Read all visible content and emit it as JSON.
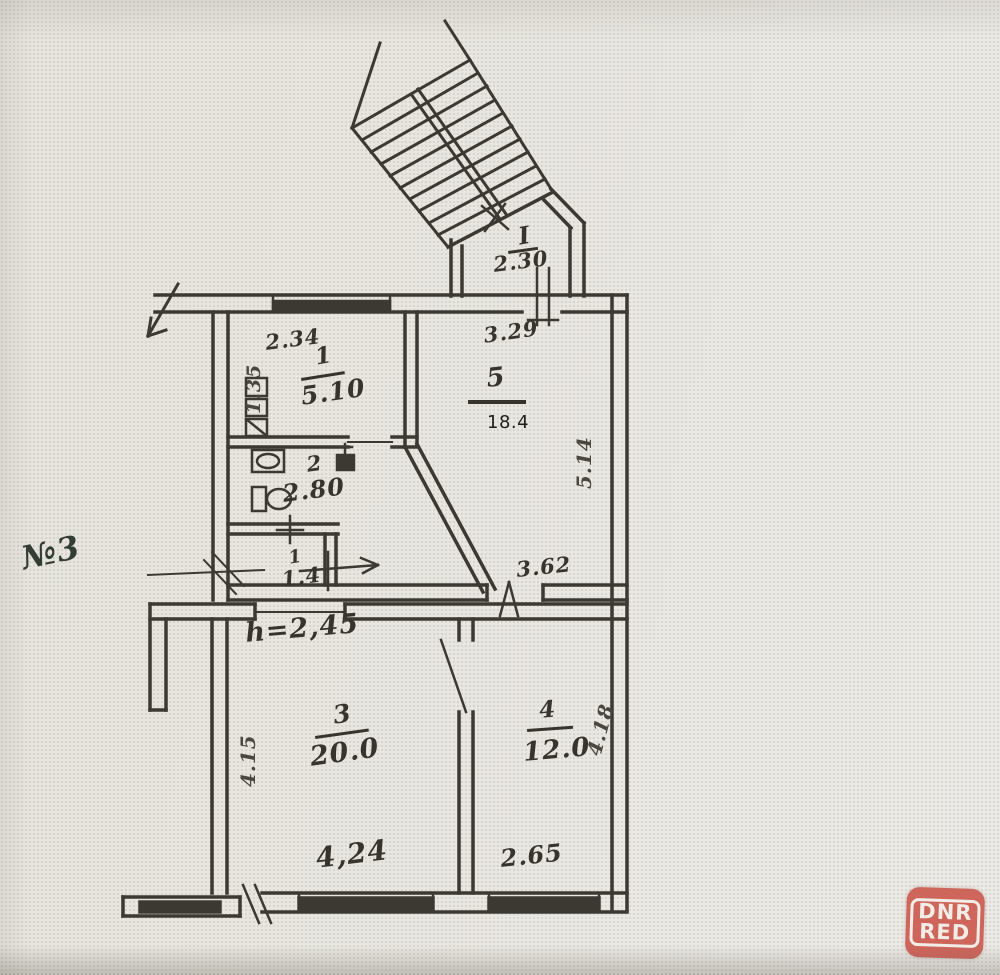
{
  "photo_note": "№3",
  "watermark": {
    "line1": "DNR",
    "line2": "RED"
  },
  "plan": {
    "ceiling_height": "h=2,45",
    "entrance_hall": {
      "num": "I",
      "width": "2.30"
    },
    "rooms": {
      "room1": {
        "num": "1",
        "area": "5.10"
      },
      "room2": {
        "num": "2",
        "area": "2.80"
      },
      "hall": {
        "num": "1",
        "area": "1.4"
      },
      "room5": {
        "num": "5",
        "area": "18.4"
      },
      "room3": {
        "num": "3",
        "area": "20.0"
      },
      "room4": {
        "num": "4",
        "area": "12.0"
      }
    },
    "dims": {
      "room1_top": "2.34",
      "room1_left": "1.35",
      "room5_top": "3.29",
      "room5_right": "5.14",
      "room5_bottom": "3.62",
      "room3_left": "4.15",
      "room3_bottom": "4,24",
      "room4_right": "4.18",
      "room4_bottom": "2.65"
    }
  }
}
